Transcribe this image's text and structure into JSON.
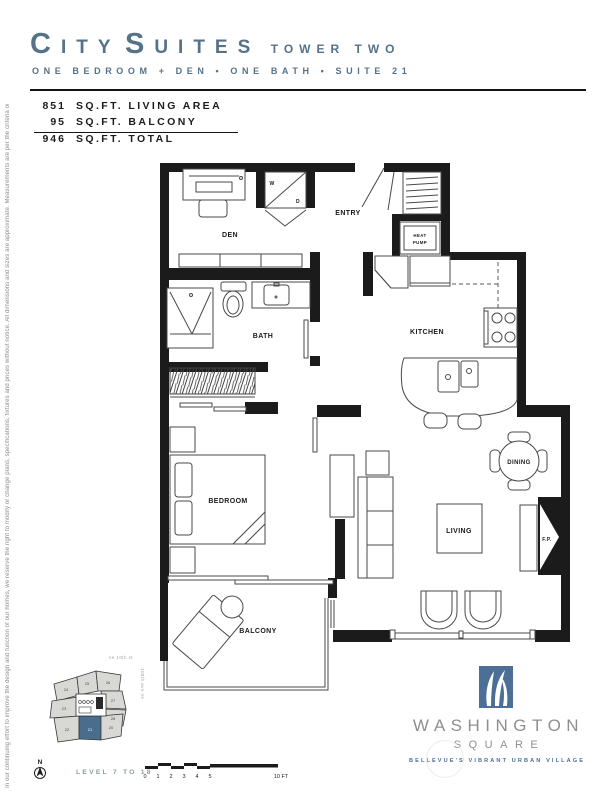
{
  "header": {
    "title_word1": "CITY",
    "title_word2": "SUITES",
    "title_suffix": "TOWER TWO",
    "subtitle": "ONE BEDROOM + DEN • ONE BATH • SUITE 21"
  },
  "stats": {
    "living_value": "851",
    "living_label": "SQ.FT. LIVING AREA",
    "balcony_value": "95",
    "balcony_label": "SQ.FT. BALCONY",
    "total_value": "946",
    "total_label": "SQ.FT. TOTAL"
  },
  "disclaimer": "In our continuing effort to improve the design and function of our homes, we reserve the right to modify or change plans, specifications, fixtures and prices without notice. All dimensions and sizes are approximate. Measurements are per the criteria outlined in the public offering statement.",
  "floorplan": {
    "rooms": {
      "den": "DEN",
      "entry": "ENTRY",
      "heat_pump_line1": "HEAT",
      "heat_pump_line2": "PUMP",
      "kitchen": "KITCHEN",
      "bath": "BATH",
      "bedroom": "BEDROOM",
      "living": "LIVING",
      "dining": "DINING",
      "balcony": "BALCONY",
      "fireplace": "F.P.",
      "washer": "W",
      "dryer": "D"
    }
  },
  "keyplan": {
    "street_top": "ne 10th st",
    "street_right": "108th ave ne",
    "north": "N",
    "level": "LEVEL 7 TO 18",
    "units": {
      "u20": "20",
      "u21": "21",
      "u22": "22",
      "u23": "23",
      "u24": "24",
      "u25": "25",
      "u26": "26",
      "u27": "27",
      "u28": "28"
    },
    "highlighted_unit": "21",
    "highlight_color": "#4a6d8e"
  },
  "scalebar": {
    "t0": "0",
    "t1": "1",
    "t2": "2",
    "t3": "3",
    "t4": "4",
    "t5": "5",
    "end": "10 FT"
  },
  "logo": {
    "line1": "WASHINGTON",
    "line2": "SQUARE",
    "tagline": "BELLEVUE'S VIBRANT URBAN VILLAGE"
  },
  "colors": {
    "brand_blue": "#547389",
    "logo_blue": "#4c6f96",
    "wall": "#1b1b1b"
  }
}
